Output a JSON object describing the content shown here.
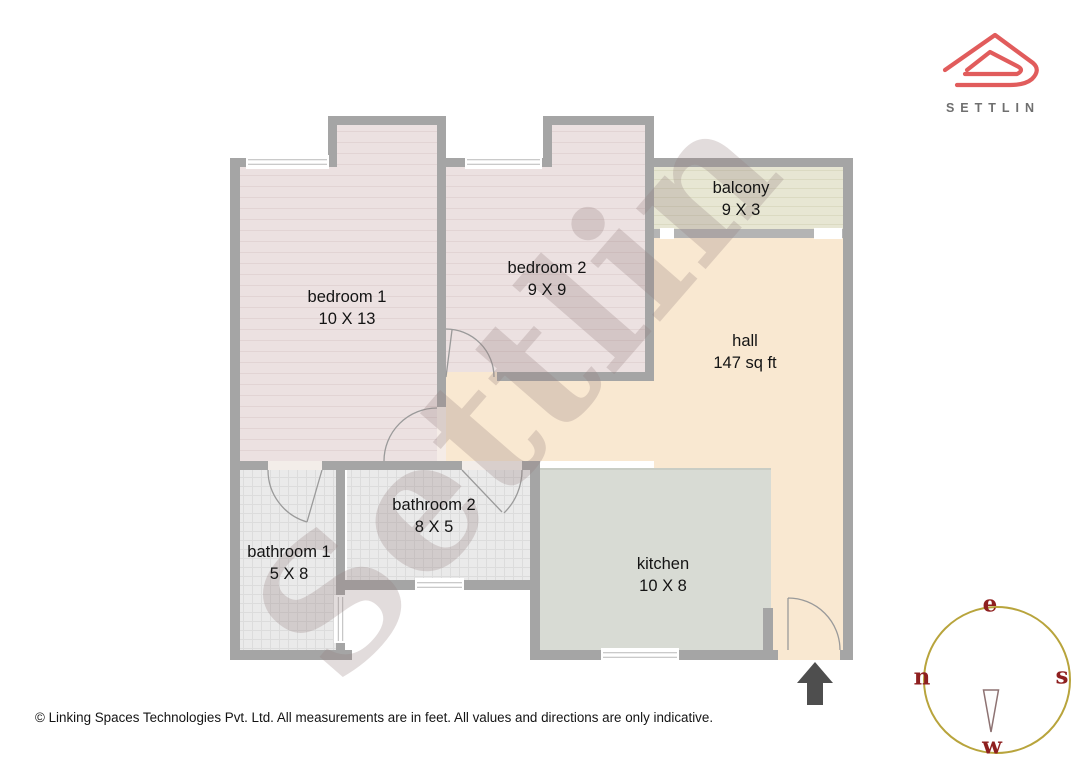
{
  "brand": {
    "name": "SETTLIN"
  },
  "watermark_text": "Settlin",
  "rooms": [
    {
      "id": "bedroom1",
      "label": "bedroom 1",
      "dims": "10 X 13"
    },
    {
      "id": "bedroom2",
      "label": "bedroom 2",
      "dims": "9 X 9"
    },
    {
      "id": "balcony",
      "label": "balcony",
      "dims": "9 X 3"
    },
    {
      "id": "hall",
      "label": "hall",
      "dims": "147 sq ft"
    },
    {
      "id": "bathroom1",
      "label": "bathroom 1",
      "dims": "5 X 8"
    },
    {
      "id": "bathroom2",
      "label": "bathroom 2",
      "dims": "8 X 5"
    },
    {
      "id": "kitchen",
      "label": "kitchen",
      "dims": "10 X 8"
    }
  ],
  "compass": {
    "top": "e",
    "left": "n",
    "right": "s",
    "bottom": "w"
  },
  "footer": {
    "copyright": "© Linking Spaces Technologies Pvt. Ltd. All measurements are in feet. All values and directions are only indicative."
  },
  "colors": {
    "wall": "#a5a5a5",
    "hall_floor": "#f9e8d1",
    "bedroom_floor": "#ece1e1",
    "balcony_floor": "#e7e6d3",
    "bathroom_floor": "#eaeaea",
    "kitchen_floor": "#d8dbd4",
    "logo_red": "#e15c5c",
    "compass_letter": "#8e1f1f",
    "compass_ring": "#b8a43c"
  }
}
